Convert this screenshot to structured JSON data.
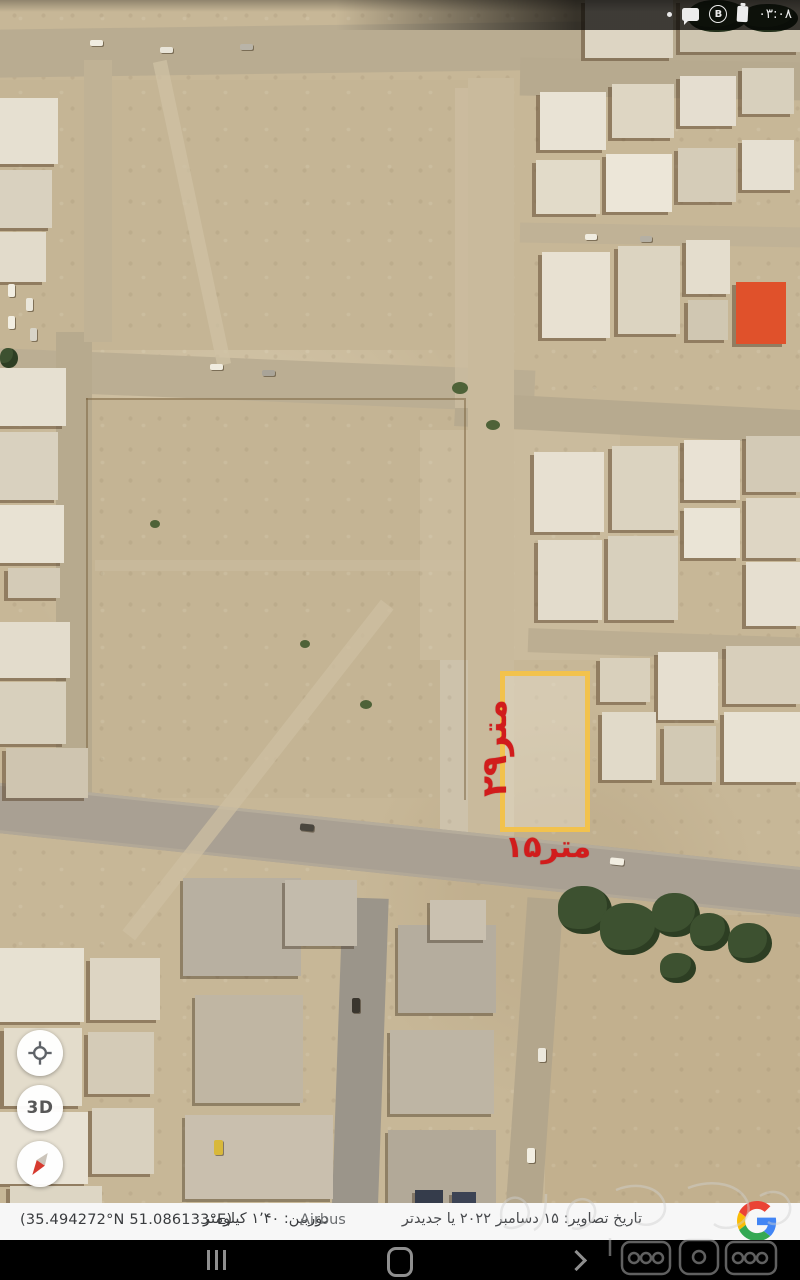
{
  "status_bar": {
    "time": "۰۳:۰۸",
    "circle_badge_label": "B"
  },
  "annotations": {
    "plot_height_label": "۲۹متر",
    "plot_width_label": "۱۵متر",
    "plot_outline_color": "#f2c24d",
    "annotation_color": "#d11c1c"
  },
  "controls": {
    "three_d_label": "3D"
  },
  "info_bar": {
    "coordinates": "(35.494272°N 51.086133°E)",
    "camera_distance": "دوربین: ۱٬۴۰ کیلومتر",
    "imagery_provider": "Airbus",
    "imagery_date": "تاریخ تصاویر: ۱۵ دسامبر ۲۰۲۲ یا جدیدتر"
  }
}
